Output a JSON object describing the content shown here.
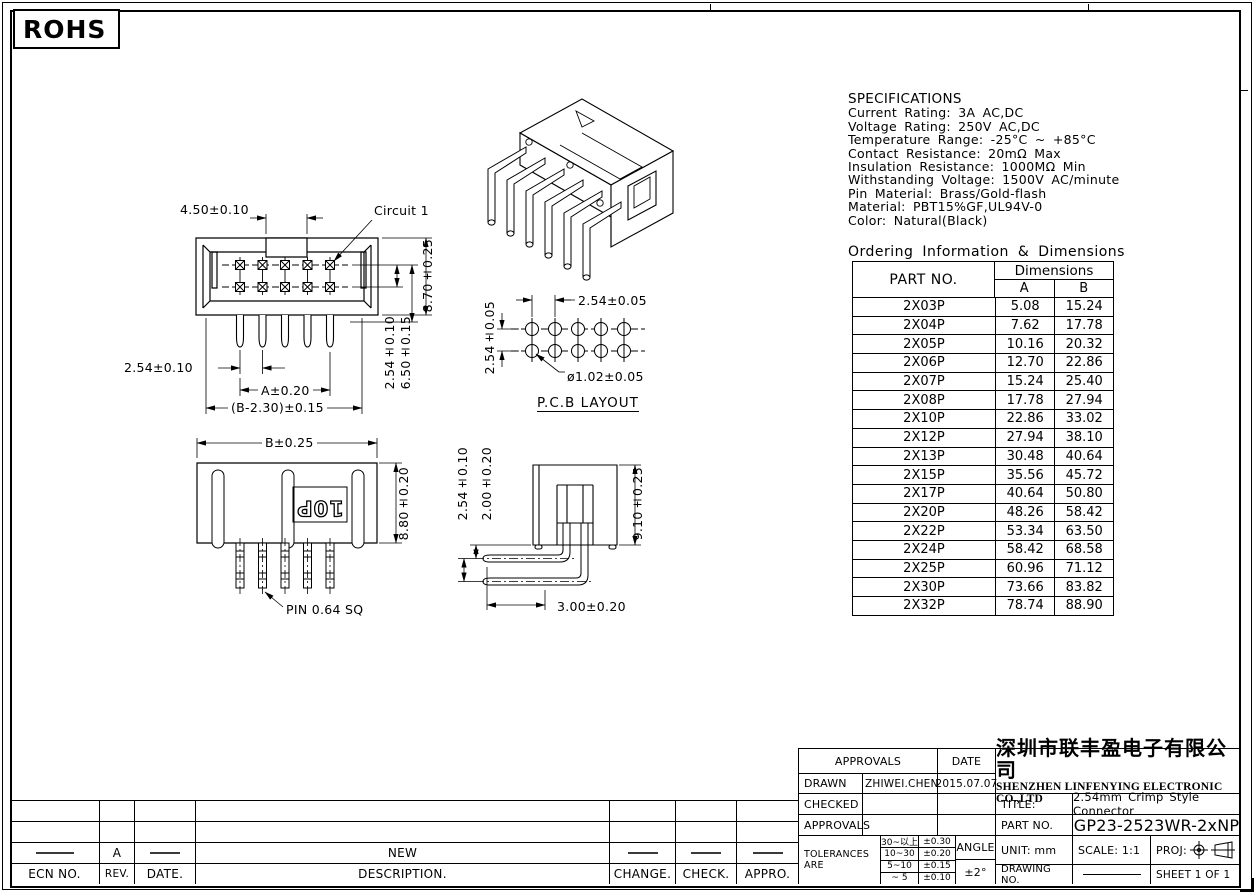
{
  "rohs": "ROHS",
  "specifications": {
    "title": "SPECIFICATIONS",
    "lines": [
      "Current Rating: 3A AC,DC",
      "Voltage Rating: 250V AC,DC",
      "Temperature Range: -25°C ~ +85°C",
      "Contact Resistance: 20mΩ Max",
      "Insulation Resistance: 1000MΩ Min",
      "Withstanding Voltage: 1500V AC/minute",
      "Pin Material: Brass/Gold-flash",
      "Material: PBT15%GF,UL94V-0",
      "Color: Natural(Black)"
    ]
  },
  "ordering": {
    "heading": "Ordering Information & Dimensions",
    "part_no_header": "PART NO.",
    "dimensions_header": "Dimensions",
    "col_a": "A",
    "col_b": "B",
    "rows": [
      {
        "p": "2X03P",
        "a": "5.08",
        "b": "15.24"
      },
      {
        "p": "2X04P",
        "a": "7.62",
        "b": "17.78"
      },
      {
        "p": "2X05P",
        "a": "10.16",
        "b": "20.32"
      },
      {
        "p": "2X06P",
        "a": "12.70",
        "b": "22.86"
      },
      {
        "p": "2X07P",
        "a": "15.24",
        "b": "25.40"
      },
      {
        "p": "2X08P",
        "a": "17.78",
        "b": "27.94"
      },
      {
        "p": "2X10P",
        "a": "22.86",
        "b": "33.02"
      },
      {
        "p": "2X12P",
        "a": "27.94",
        "b": "38.10"
      },
      {
        "p": "2X13P",
        "a": "30.48",
        "b": "40.64"
      },
      {
        "p": "2X15P",
        "a": "35.56",
        "b": "45.72"
      },
      {
        "p": "2X17P",
        "a": "40.64",
        "b": "50.80"
      },
      {
        "p": "2X20P",
        "a": "48.26",
        "b": "58.42"
      },
      {
        "p": "2X22P",
        "a": "53.34",
        "b": "63.50"
      },
      {
        "p": "2X24P",
        "a": "58.42",
        "b": "68.58"
      },
      {
        "p": "2X25P",
        "a": "60.96",
        "b": "71.12"
      },
      {
        "p": "2X30P",
        "a": "73.66",
        "b": "83.82"
      },
      {
        "p": "2X32P",
        "a": "78.74",
        "b": "88.90"
      }
    ]
  },
  "front_view": {
    "dim_top": "4.50±0.10",
    "circuit_label": "Circuit 1",
    "dim_height": "8.70±0.25",
    "dim_row_pitch": "2.54±0.10",
    "dim_pin_depth": "6.50±0.15",
    "dim_pitch": "2.54±0.10",
    "dim_a": "A±0.20",
    "dim_b": "(B-2.30)±0.15"
  },
  "pcb_layout": {
    "dim_h": "2.54±0.05",
    "dim_v": "2.54±0.05",
    "hole": "ø1.02±0.05",
    "caption": "P.C.B LAYOUT"
  },
  "bottom_view": {
    "dim_b": "B±0.25",
    "dim_h": "8.80±0.20",
    "marking": "10P",
    "pin_label": "PIN 0.64 SQ"
  },
  "side_view": {
    "dim_pitch": "2.54±0.10",
    "dim_standoff": "2.00±0.20",
    "dim_height": "9.10±0.25",
    "dim_tail": "3.00±0.20"
  },
  "revision": {
    "rev_value": "A",
    "description_value": "NEW",
    "headers": {
      "ecn": "ECN NO.",
      "rev": "REV.",
      "date": "DATE.",
      "description": "DESCRIPTION.",
      "change": "CHANGE.",
      "check": "CHECK.",
      "appro": "APPRO."
    }
  },
  "title_block": {
    "approvals_header": "APPROVALS",
    "date_header": "DATE",
    "drawn_label": "DRAWN",
    "drawn_name": "ZHIWEI.CHEN",
    "drawn_date": "2015.07.07",
    "checked_label": "CHECKED",
    "approvals_label": "APPROVALS",
    "tolerances_label": "TOLERANCES ARE",
    "tolerances": [
      [
        "30~以上",
        "±0.30"
      ],
      [
        "10~30",
        "±0.20"
      ],
      [
        "5~10",
        "±0.15"
      ],
      [
        "~ 5",
        "±0.10"
      ]
    ],
    "angle_label": "ANGLE",
    "angle_value": "±2°",
    "company_cn": "深圳市联丰盈电子有限公司",
    "company_en": "SHENZHEN LINFENYING ELECTRONIC CO.,LTD",
    "title_label": "TITLE:",
    "title_value": "2.54mm Crimp Style Connector",
    "part_no_label": "PART NO.",
    "part_no_value": "GP23-2523WR-2xNP",
    "unit_label": "UNIT:  mm",
    "scale_label": "SCALE:   1:1",
    "proj_label": "PROJ:",
    "drawing_no_label": "DRAWING NO.",
    "sheet_label": "SHEET   1  OF  1"
  }
}
